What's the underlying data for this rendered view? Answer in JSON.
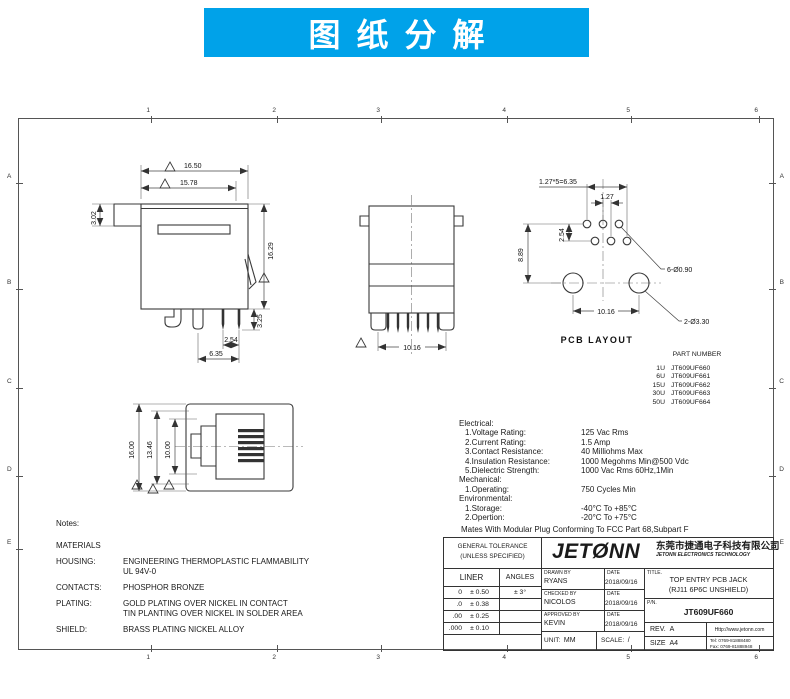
{
  "banner": {
    "title": "图纸分解"
  },
  "colors": {
    "banner_bg": "#00a2e9",
    "line": "#3a3a3a",
    "paper": "#ffffff"
  },
  "sheet": {
    "zones_h": [
      "1",
      "2",
      "3",
      "4",
      "5",
      "6"
    ],
    "zones_v": [
      "A",
      "B",
      "C",
      "D",
      "E"
    ]
  },
  "views": {
    "side": {
      "dim_w1": "16.50",
      "dim_w2": "15.78",
      "dim_tab": "3.02",
      "dim_h": "16.29",
      "dim_pin": "3.25",
      "dim_p1": "2.54",
      "dim_p2": "6.35"
    },
    "rear": {
      "dim_w": "10.16"
    },
    "pcb": {
      "caption": "PCB LAYOUT",
      "dim_total": "1.27*5=6.35",
      "dim_pitch": "1.27",
      "dim_row": "2.54",
      "dim_h": "8.89",
      "dim_span": "10.16",
      "label_pins": "6-Ø0.90",
      "label_holes": "2-Ø3.30"
    },
    "front": {
      "dim_h1": "16.00",
      "dim_h2": "13.46",
      "dim_h3": "10.00"
    }
  },
  "part_number": {
    "title": "PART NUMBER",
    "rows": [
      {
        "code": "1U",
        "pn": "JT609UF660"
      },
      {
        "code": "6U",
        "pn": "JT609UF661"
      },
      {
        "code": "15U",
        "pn": "JT609UF662"
      },
      {
        "code": "30U",
        "pn": "JT609UF663"
      },
      {
        "code": "50U",
        "pn": "JT609UF664"
      }
    ]
  },
  "specs": {
    "electrical_title": "Electrical:",
    "electrical": [
      {
        "label": "1.Voltage Rating:",
        "value": "125 Vac Rms"
      },
      {
        "label": "2.Current Rating:",
        "value": "1.5 Amp"
      },
      {
        "label": "3.Contact Resistance:",
        "value": "40 Milliohms Max"
      },
      {
        "label": "4.Insulation Resistance:",
        "value": "1000 Megohms Min@500 Vdc"
      },
      {
        "label": "5.Dielectric Strength:",
        "value": "1000 Vac Rms 60Hz,1Min"
      }
    ],
    "mechanical_title": "Mechanical:",
    "mechanical": [
      {
        "label": "1.Operating:",
        "value": "750 Cycles Min"
      }
    ],
    "environmental_title": "Environmental:",
    "environmental": [
      {
        "label": "1.Storage:",
        "value": "-40°C To +85°C"
      },
      {
        "label": "2.Opertion:",
        "value": "-20°C To +75°C"
      }
    ],
    "footnote": "Mates With Modular Plug Conforming To FCC Part 68,Subpart F"
  },
  "notes": {
    "title": "Notes:",
    "materials": "MATERIALS",
    "rows": [
      {
        "label": "HOUSING:",
        "line1": "ENGINEERING THERMOPLASTIC FLAMMABILITY",
        "line2": "UL 94V-0"
      },
      {
        "label": "CONTACTS:",
        "line1": "PHOSPHOR BRONZE",
        "line2": ""
      },
      {
        "label": "PLATING:",
        "line1": "GOLD PLATING OVER NICKEL IN CONTACT",
        "line2": "TIN PLANTING OVER NICKEL IN SOLDER AREA"
      },
      {
        "label": "SHIELD:",
        "line1": "BRASS PLATING NICKEL ALLOY",
        "line2": ""
      }
    ]
  },
  "title_block": {
    "general_tolerance_1": "GENERAL TOLERANCE",
    "general_tolerance_2": "(UNLESS SPECIFIED)",
    "liner": "LINER",
    "angles": "ANGLES",
    "tol_rows": [
      {
        "d": "0",
        "t": "± 0.50",
        "a": "± 3°"
      },
      {
        "d": ".0",
        "t": "± 0.38",
        "a": ""
      },
      {
        "d": ".00",
        "t": "± 0.25",
        "a": ""
      },
      {
        "d": ".000",
        "t": "± 0.10",
        "a": ""
      }
    ],
    "drawn_label": "DRAWN BY",
    "date_label": "DATE",
    "drawn_by": "RYANS",
    "drawn_date": "2018/09/16",
    "checked_label": "CHECKED BY",
    "checked_by": "NICOLOS",
    "checked_date": "2018/09/16",
    "approved_label": "APPROVED BY",
    "approved_by": "KEVIN",
    "approved_date": "2018/09/16",
    "unit_label": "UNIT:",
    "unit": "MM",
    "scale_label": "SCALE:",
    "scale": "/",
    "logo": "JETØNN",
    "company_cn": "东莞市捷通电子科技有限公司",
    "company_en": "JETONN ELECTRONICS TECHNOLOGY",
    "title_label": "TITLE.",
    "title_line1": "TOP ENTRY PCB JACK",
    "title_line2": "(RJ11 6P6C UNSHIELD)",
    "pn_label": "P/N.",
    "pn": "JT609UF660",
    "rev_label": "REV.",
    "rev": "A",
    "size_label": "SIZE",
    "size": "A4",
    "website": "Http://www.jetonn.com",
    "tel": "Tel: 0769-81888480",
    "fax": "Fax: 0769-81888948"
  }
}
